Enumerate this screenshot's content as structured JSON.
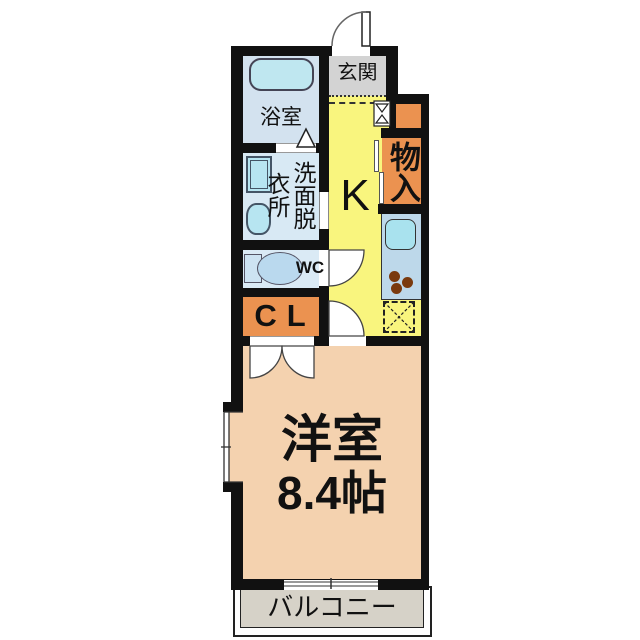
{
  "floorplan": {
    "type": "apartment-1K-floor-plan",
    "rooms": {
      "entrance": "玄関",
      "bathroom": "浴室",
      "washroom": "洗面脱衣所",
      "washroom_display": "洗面脱\n衣所",
      "wc": "WC",
      "closet": "CL",
      "kitchen": "K",
      "storage": "物入",
      "main_room": "洋室",
      "main_room_size": "8.4帖",
      "balcony": "バルコニー"
    },
    "fixtures": [
      "bathtub-icon",
      "washing-machine-icon",
      "vanity-sink-icon",
      "toilet-icon",
      "kitchen-sink-icon",
      "stove-burners-icon",
      "refrigerator-space-dashed-box",
      "entry-door-swing",
      "wc-door-swing",
      "kitchen-door-swing",
      "closet-double-door-swing",
      "bathroom-folding-door-marker",
      "storage-sliding-door",
      "window-symbol",
      "balcony-railing"
    ],
    "colors": {
      "wall": "#111111",
      "bathroom_floor": "#d3e2ef",
      "bathtub": "#bfe7f0",
      "washroom_floor": "#d8e9f4",
      "fixture_cyan": "#b7e5f1",
      "wc_floor": "#daeaf5",
      "toilet": "#bad9ee",
      "entrance_gray": "#d3d3d3",
      "kitchen_yellow": "#f9f57e",
      "storage_orange": "#eb9250",
      "counter_blue": "#bdd8ea",
      "kitchen_sink": "#a9e2ee",
      "burner_brown": "#7a3a0e",
      "room_peach": "#f4d2af",
      "balcony_gray": "#d6d2c8"
    }
  }
}
